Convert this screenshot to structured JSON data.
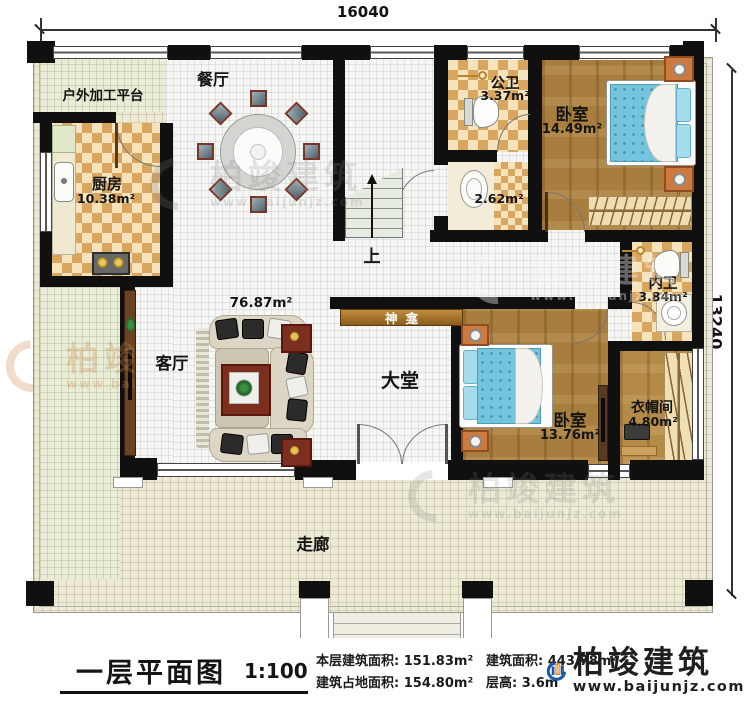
{
  "dimensions": {
    "width_mm": "16040",
    "height_mm": "13240"
  },
  "rooms": {
    "outdoor_platform": {
      "label": "户外加工平台"
    },
    "kitchen": {
      "label": "厨房",
      "area": "10.38m²"
    },
    "dining": {
      "label": "餐厅"
    },
    "public_bath": {
      "label": "公卫",
      "area": "3.37m²"
    },
    "wash_area": {
      "area": "2.62m²"
    },
    "bedroom1": {
      "label": "卧室",
      "area": "14.49m²"
    },
    "inner_bath": {
      "label": "内卫",
      "area": "3.84m²"
    },
    "bedroom2": {
      "label": "卧室",
      "area": "13.76m²"
    },
    "cloakroom": {
      "label": "衣帽间",
      "area": "4.80m²"
    },
    "living": {
      "label": "客厅"
    },
    "living_dining": {
      "area": "76.87m²"
    },
    "shrine": {
      "label": "神龛"
    },
    "hall": {
      "label": "大堂"
    },
    "corridor": {
      "label": "走廊"
    },
    "stairs": {
      "label": "上"
    }
  },
  "title_block": {
    "title": "一层平面图",
    "scale": "1:100",
    "stats": [
      {
        "label": "本层建筑面积:",
        "value": "151.83m²"
      },
      {
        "label": "建筑占地面积:",
        "value": "154.80m²"
      },
      {
        "label": "建筑面积:",
        "value": "443.78m²"
      },
      {
        "label": "层高:",
        "value": "3.6m"
      }
    ]
  },
  "brand": {
    "name": "柏竣建筑",
    "url": "www.baijunjz.com"
  },
  "watermark": {
    "name": "柏竣建筑",
    "url": "www.baijunjz.com"
  },
  "colors": {
    "wall": "#101010",
    "checker": "#d9a660",
    "wood": "#a87e3e",
    "bed": "#74c4dd",
    "terrace": "#ece9d6",
    "brand_blue": "#1b5aa5",
    "brand_orange": "#f0861c"
  }
}
